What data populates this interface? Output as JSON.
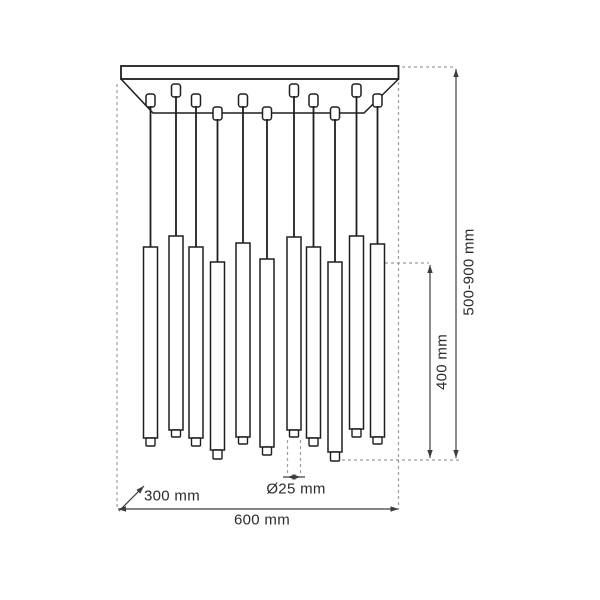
{
  "labels": {
    "overall_height": "500-900 mm",
    "tube_length": "400 mm",
    "tube_diameter": "Ø25 mm",
    "canopy_depth": "300 mm",
    "canopy_width": "600 mm"
  },
  "drawing": {
    "canvas": {
      "width": 600,
      "height": 600,
      "background": "#ffffff"
    },
    "colors": {
      "outline": "#1f1f1f",
      "dimension": "#3c3c3c",
      "dashed": "#9c9c9c",
      "text": "#2b2b2b",
      "fill": "#ffffff"
    },
    "pendant_count": 11,
    "canopy": {
      "plate": {
        "x": 121,
        "y": 66,
        "width": 277.5,
        "height": 13
      },
      "underside": {
        "left": [
          121,
          79
        ],
        "left_inner": [
          153,
          113
        ],
        "right_inner": [
          364,
          113
        ],
        "right": [
          398.5,
          79
        ]
      }
    },
    "connector": {
      "width": 9,
      "height": 13,
      "corner_radius": 2.5
    },
    "connector_rows": {
      "front": 84,
      "middle": 94,
      "back": 107
    },
    "tube": {
      "width": 14,
      "tip_width": 9
    },
    "pendants": [
      {
        "cx": 150.5,
        "row": "middle",
        "tube_top": 247,
        "tube_bottom": 438,
        "tip_bottom": 446
      },
      {
        "cx": 176.0,
        "row": "front",
        "tube_top": 236,
        "tube_bottom": 430,
        "tip_bottom": 437
      },
      {
        "cx": 196.0,
        "row": "middle",
        "tube_top": 247,
        "tube_bottom": 438,
        "tip_bottom": 446
      },
      {
        "cx": 217.5,
        "row": "back",
        "tube_top": 262,
        "tube_bottom": 450,
        "tip_bottom": 459
      },
      {
        "cx": 243.0,
        "row": "middle",
        "tube_top": 243,
        "tube_bottom": 437,
        "tip_bottom": 444
      },
      {
        "cx": 267.0,
        "row": "back",
        "tube_top": 259,
        "tube_bottom": 447,
        "tip_bottom": 455
      },
      {
        "cx": 294.0,
        "row": "front",
        "tube_top": 237,
        "tube_bottom": 430,
        "tip_bottom": 437
      },
      {
        "cx": 313.5,
        "row": "middle",
        "tube_top": 247,
        "tube_bottom": 438,
        "tip_bottom": 446
      },
      {
        "cx": 335.0,
        "row": "back",
        "tube_top": 262,
        "tube_bottom": 452,
        "tip_bottom": 461
      },
      {
        "cx": 356.5,
        "row": "front",
        "tube_top": 236,
        "tube_bottom": 429,
        "tip_bottom": 437
      },
      {
        "cx": 377.5,
        "row": "middle",
        "tube_top": 244,
        "tube_bottom": 437,
        "tip_bottom": 444
      }
    ],
    "extension_lines": [
      {
        "x1": 117,
        "y1": 84,
        "x2": 117,
        "y2": 509
      },
      {
        "x1": 398.5,
        "y1": 82,
        "x2": 398.5,
        "y2": 509
      },
      {
        "x1": 402,
        "y1": 67,
        "x2": 455,
        "y2": 67
      },
      {
        "x1": 385,
        "y1": 263,
        "x2": 429,
        "y2": 263
      },
      {
        "x1": 342,
        "y1": 460,
        "x2": 462,
        "y2": 460
      },
      {
        "x1": 287.5,
        "y1": 440,
        "x2": 287.5,
        "y2": 473
      },
      {
        "x1": 300.5,
        "y1": 440,
        "x2": 300.5,
        "y2": 473
      }
    ],
    "dimension_lines": [
      {
        "name": "overall-height-dim",
        "x1": 456,
        "y1": 69,
        "x2": 456,
        "y2": 458,
        "heads": [
          {
            "x": 456,
            "y": 69,
            "angle": -90
          },
          {
            "x": 456,
            "y": 458,
            "angle": 90
          }
        ]
      },
      {
        "name": "tube-length-dim",
        "x1": 430,
        "y1": 265,
        "x2": 430,
        "y2": 458,
        "heads": [
          {
            "x": 430,
            "y": 265,
            "angle": -90
          },
          {
            "x": 430,
            "y": 458,
            "angle": 90
          }
        ]
      },
      {
        "name": "overall-width-dim",
        "x1": 118,
        "y1": 509,
        "x2": 398.5,
        "y2": 509,
        "heads": [
          {
            "x": 118,
            "y": 509,
            "angle": 180
          },
          {
            "x": 398.5,
            "y": 509,
            "angle": 0
          }
        ]
      },
      {
        "name": "tube-diameter-dim",
        "x1": 283,
        "y1": 477,
        "x2": 305,
        "y2": 477,
        "heads": [
          {
            "x": 287.5,
            "y": 477,
            "angle": 180
          },
          {
            "x": 300.5,
            "y": 477,
            "angle": 0
          }
        ]
      },
      {
        "name": "canopy-depth-dim",
        "x1": 119,
        "y1": 511,
        "x2": 144,
        "y2": 486,
        "heads": [
          {
            "x": 144,
            "y": 486,
            "angle": -45
          }
        ]
      }
    ]
  }
}
